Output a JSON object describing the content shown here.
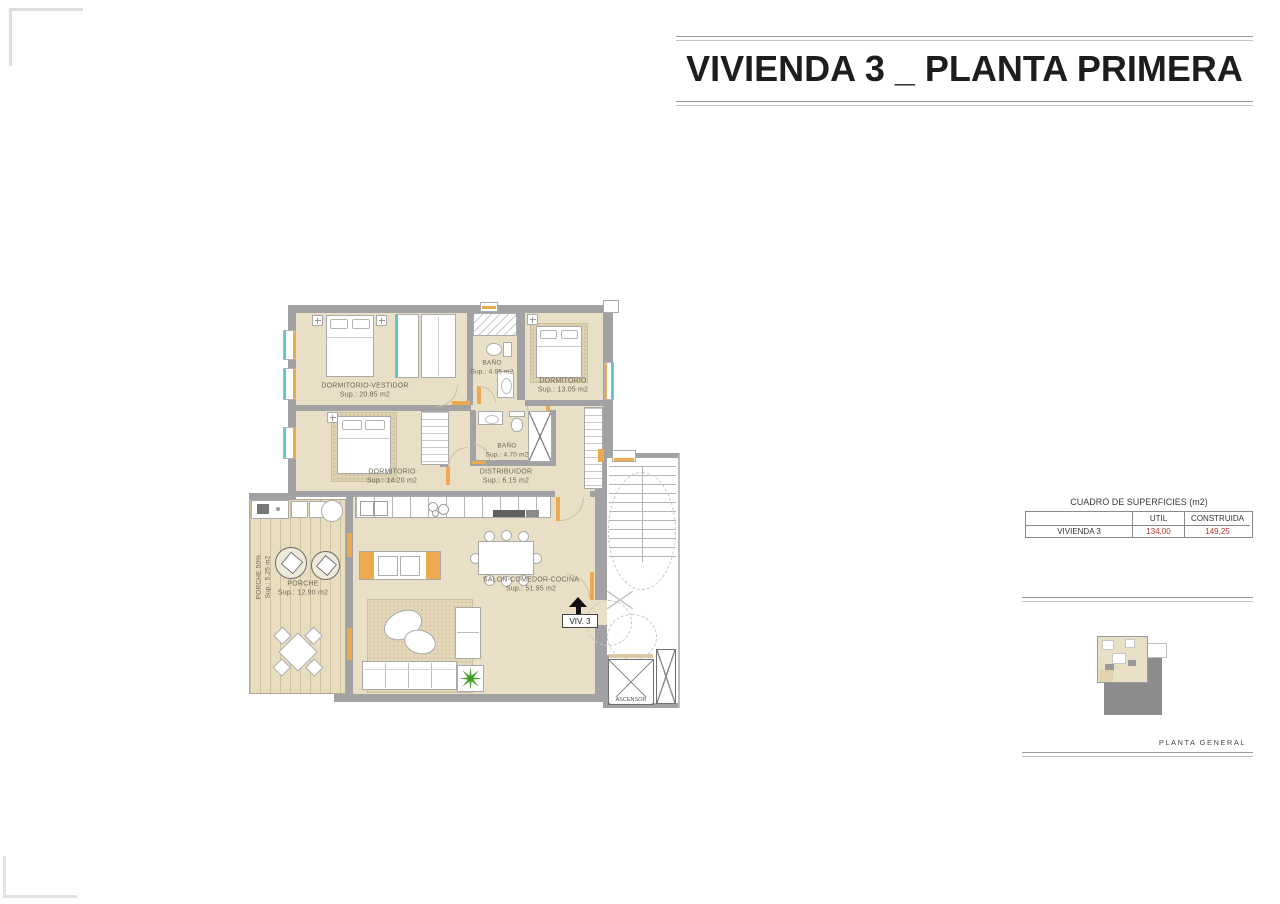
{
  "title": "VIVIENDA 3 _ PLANTA PRIMERA",
  "surfaces_table": {
    "title": "CUADRO DE SUPERFICIES (m2)",
    "columns": [
      "UTIL",
      "CONSTRUIDA"
    ],
    "rows": [
      {
        "name": "VIVIENDA 3",
        "util": "134,00",
        "construida": "149,25"
      }
    ]
  },
  "site_plan": {
    "caption": "PLANTA GENERAL"
  },
  "entry": {
    "label": "VIV. 3"
  },
  "elevator_label": "ASCENSOR",
  "rooms": [
    {
      "name": "DORMITORIO-VESTIDOR",
      "sup": "Sup.: 20.85 m2"
    },
    {
      "name": "BAÑO",
      "sup": "Sup.: 4.95 m2"
    },
    {
      "name": "DORMITORIO",
      "sup": "Sup.: 13.05 m2"
    },
    {
      "name": "DORMITORIO",
      "sup": "Sup.: 14.20 m2"
    },
    {
      "name": "BAÑO",
      "sup": "Sup.: 4.70 m2"
    },
    {
      "name": "DISTRIBUIDOR",
      "sup": "Sup.: 6.15 m2"
    },
    {
      "name": "SALON-COMEDOR-COCINA",
      "sup": "Sup.: 51.95 m2"
    },
    {
      "name": "PORCHE",
      "sup": "Sup.: 12.90 m2"
    },
    {
      "name": "PORCHE 50%",
      "sup": "Sup.: 5.25 m2"
    }
  ],
  "icons": {
    "entry_arrow": "arrow-up-icon",
    "plant": "plant-icon"
  },
  "colors": {
    "floor": "#e9dfc6",
    "porch": "#e8ddbf",
    "wall": "#a2a2a5",
    "orange": "#eda94d",
    "teal": "#5cc4cf",
    "red": "#b5372d",
    "green": "#3f9b22",
    "gray": "#8c8c8c"
  }
}
